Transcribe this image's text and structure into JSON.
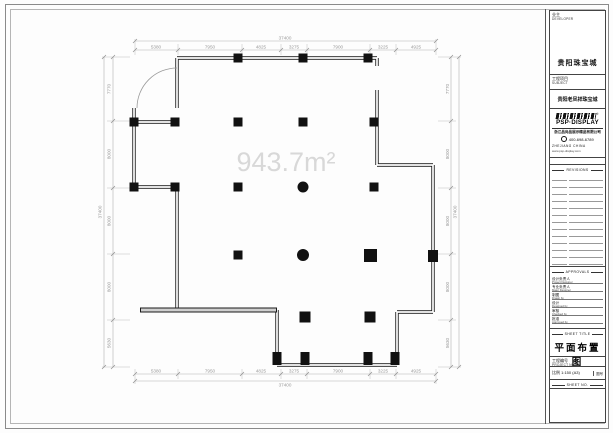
{
  "panel": {
    "developer_label_cn": "业主",
    "developer_label_en": "DEVELOPER",
    "developer_name": "贵阳珠宝城",
    "subject_label_cn": "工程项目",
    "subject_label_en": "SUBJECT",
    "subject_name": "贵阳老凤祥珠宝城",
    "logo": {
      "wordmark": "PSP·DISPLAY",
      "reg_mark": "®",
      "company": "浙江品尚品展示精品有限公司",
      "phone": "400-698-6789",
      "region": "ZHEJIANG CHINA",
      "website": "www.psp-display.com"
    },
    "revisions_header": "REVISIONS",
    "approvals_header": "APPROVALS",
    "approvals": [
      {
        "cn": "设计负责人",
        "en": "Project Designer"
      },
      {
        "cn": "专业负责人",
        "en": "Major Designer"
      },
      {
        "cn": "制图",
        "en": "Drawn by"
      },
      {
        "cn": "设计",
        "en": "Designed by"
      },
      {
        "cn": "审核",
        "en": "Checked by"
      },
      {
        "cn": "批准",
        "en": "Approved by"
      }
    ],
    "sheet_title_header": "SHEET TITLE",
    "sheet_title": "平面布置图",
    "project_no_cn": "工程编号",
    "project_no_en": "PROJECT NO.",
    "scale_cn": "比例",
    "scale_value": "1:150 (A3)",
    "drawing_no_cn": "图号",
    "sheet_no_header": "SHEET NO."
  },
  "plan": {
    "area_label": "943.7m²",
    "overall_top": "37400",
    "overall_bottom": "37400",
    "overall_left": "37400",
    "overall_right": "37400",
    "dims_top": [
      "5380",
      "7950",
      "4825",
      "3275",
      "7900",
      "3225",
      "4925"
    ],
    "dims_bottom": [
      "5380",
      "7950",
      "4825",
      "3275",
      "7900",
      "3225",
      "4925"
    ],
    "dims_left": [
      "7770",
      "8000",
      "8000",
      "8000",
      "5630"
    ],
    "dims_right": [
      "7770",
      "8000",
      "8000",
      "8000",
      "5630"
    ]
  }
}
